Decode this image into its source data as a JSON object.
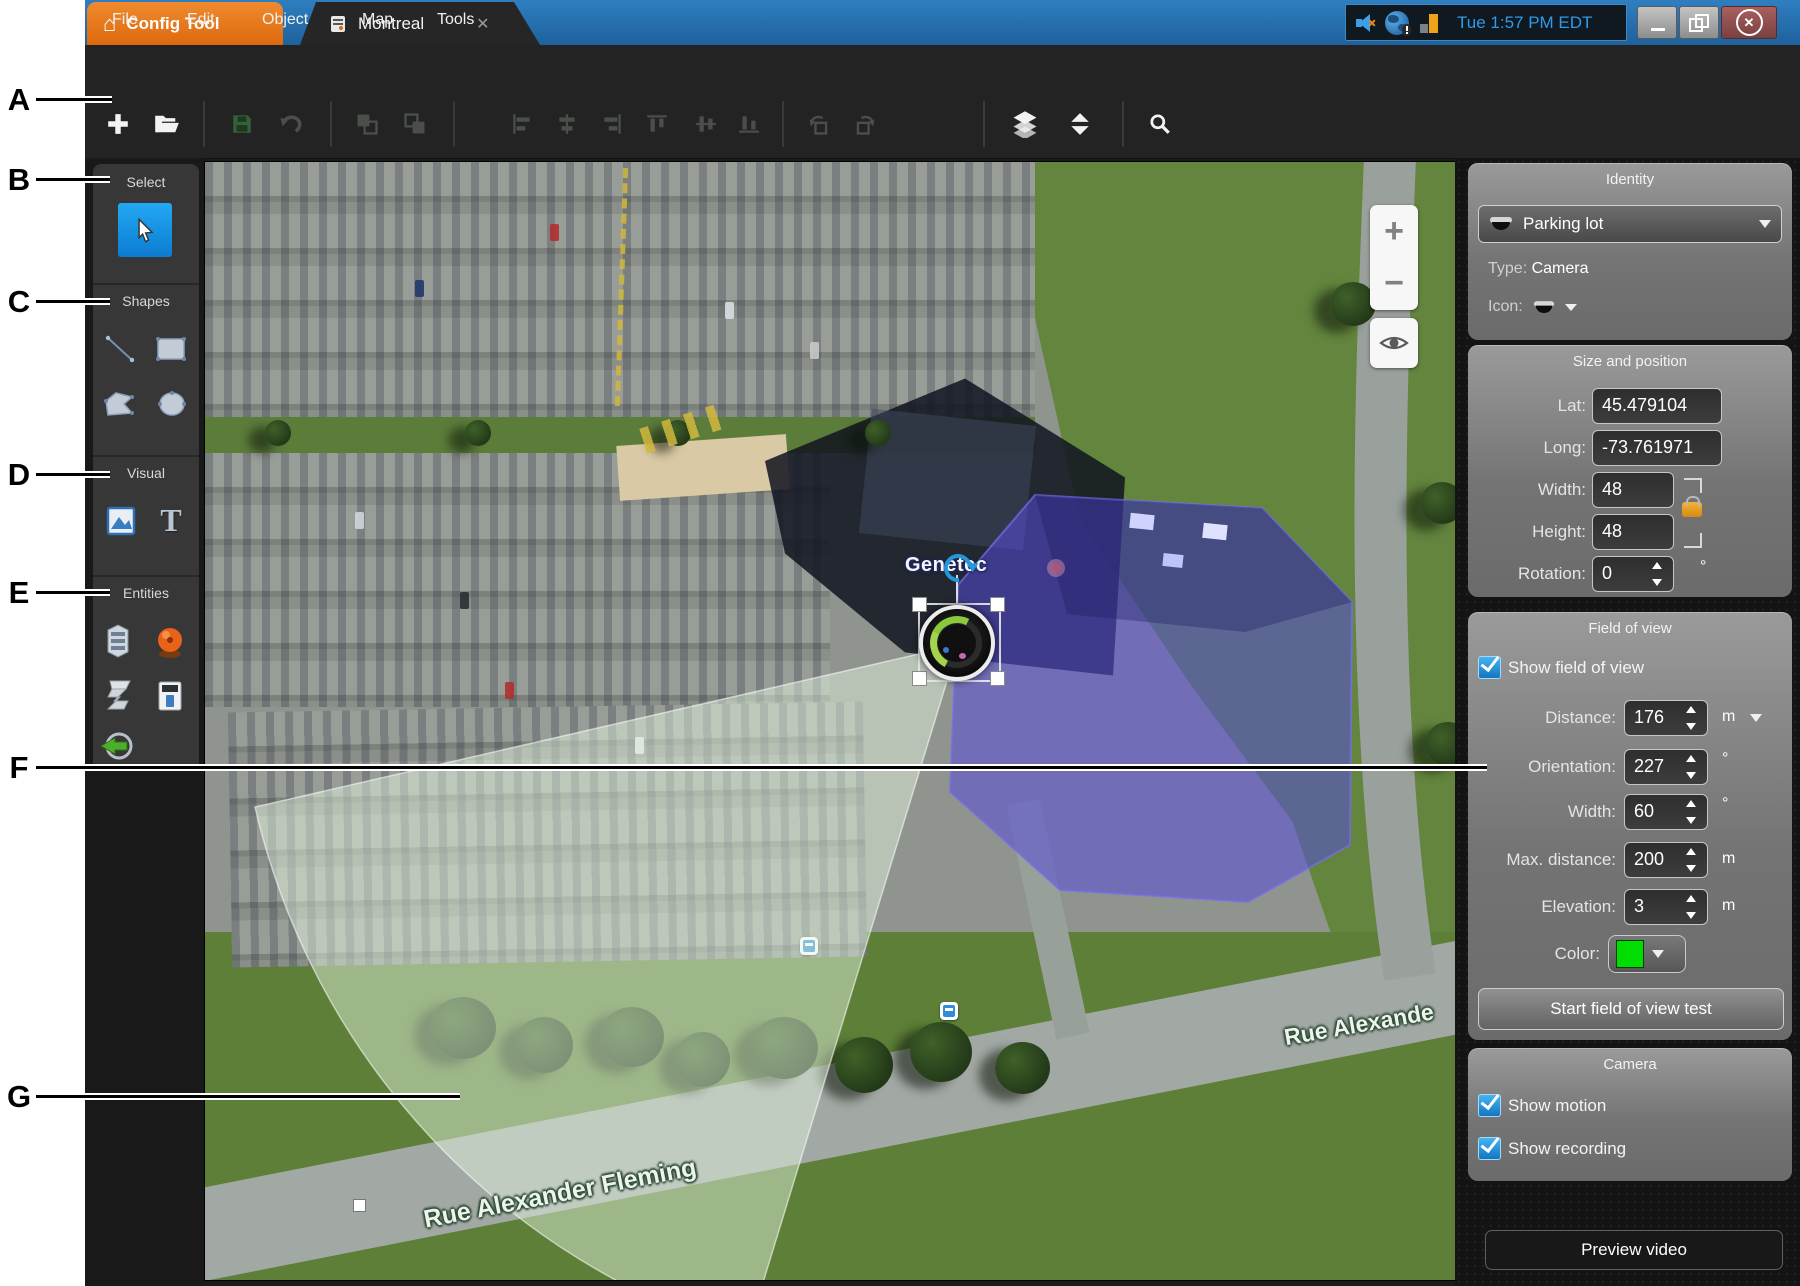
{
  "annotations": {
    "letters": [
      "A",
      "B",
      "C",
      "D",
      "E",
      "F",
      "G"
    ]
  },
  "title_bar": {
    "app_tab": "Config Tool",
    "map_tab": "Montreal",
    "clock": "Tue 1:57 PM EDT"
  },
  "glyphs": {
    "home": "⌂",
    "tab_close": "✕",
    "window_close": "✕",
    "zoom_in": "+",
    "zoom_out": "−",
    "text_tool": "T"
  },
  "menu": {
    "items": [
      "File",
      "Edit",
      "Object",
      "Map",
      "Tools"
    ]
  },
  "toolbar": {
    "icons": [
      "add",
      "open",
      "save",
      "undo",
      "bring-forward",
      "send-backward",
      "align-left",
      "align-center-horizontal",
      "align-right",
      "align-top",
      "align-middle-vertical",
      "align-bottom",
      "rotate-left",
      "rotate-right",
      "layers",
      "stack-order",
      "search"
    ]
  },
  "sidebar": {
    "sections": [
      {
        "title": "Select"
      },
      {
        "title": "Shapes"
      },
      {
        "title": "Visual"
      },
      {
        "title": "Entities"
      }
    ]
  },
  "map": {
    "street_label": "Rue Alexander Fleming",
    "street_label_2": "Rue Alexande",
    "building_label": "Genetec"
  },
  "panel": {
    "identity": {
      "title": "Identity",
      "entity_name": "Parking lot",
      "type_label": "Type:",
      "type_value": "Camera",
      "icon_label": "Icon:"
    },
    "size_position": {
      "title": "Size and position",
      "rows": [
        {
          "label": "Lat:",
          "value": "45.479104"
        },
        {
          "label": "Long:",
          "value": "-73.761971"
        },
        {
          "label": "Width:",
          "value": "48"
        },
        {
          "label": "Height:",
          "value": "48"
        },
        {
          "label": "Rotation:",
          "value": "0",
          "unit": "°"
        }
      ]
    },
    "field_of_view": {
      "title": "Field of view",
      "show_checkbox": "Show field of view",
      "rows": [
        {
          "label": "Distance:",
          "value": "176",
          "unit": "m"
        },
        {
          "label": "Orientation:",
          "value": "227",
          "unit": "°"
        },
        {
          "label": "Width:",
          "value": "60",
          "unit": "°"
        },
        {
          "label": "Max. distance:",
          "value": "200",
          "unit": "m"
        },
        {
          "label": "Elevation:",
          "value": "3",
          "unit": "m"
        }
      ],
      "color_label": "Color:",
      "color_value": "#00dd00",
      "test_button": "Start field of view test"
    },
    "camera": {
      "title": "Camera",
      "show_motion": "Show motion",
      "show_recording": "Show recording"
    },
    "preview_button": "Preview video"
  },
  "colors": {
    "accent_blue": "#2196d8",
    "fov_green": "#00dd00",
    "overlay_purple": "#5a4fd8",
    "tab_orange": "#e8791e",
    "clock_blue": "#2f9be8"
  }
}
